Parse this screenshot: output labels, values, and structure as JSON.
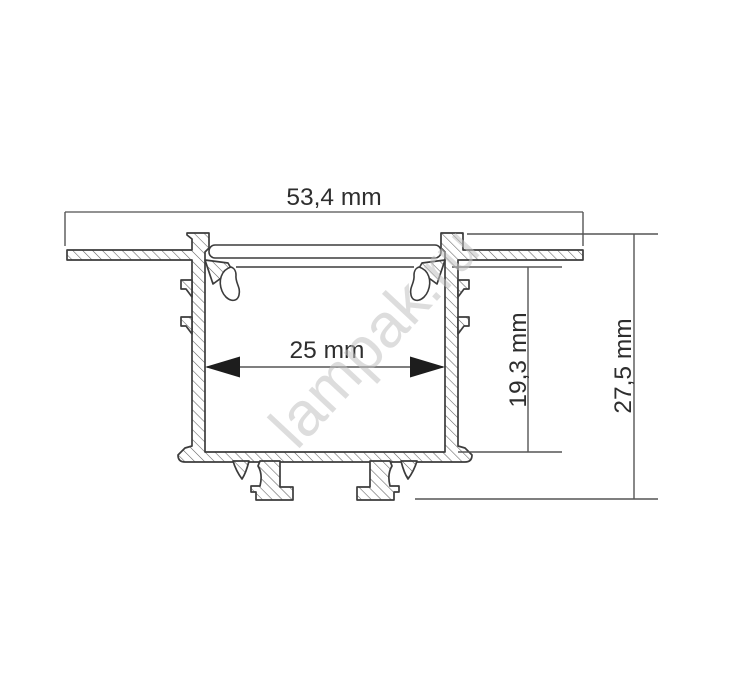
{
  "drawing": {
    "type": "technical-cross-section-profile",
    "watermark": "lampak.ru",
    "dimensions": {
      "total_width": "53,4 mm",
      "inner_width": "25 mm",
      "inner_depth": "19,3 mm",
      "total_height": "27,5 mm"
    },
    "colors": {
      "background": "#ffffff",
      "outline": "#3c3c3c",
      "hatch": "#5f5f5f",
      "dimension_line": "#6e6e6e",
      "text": "#2e2e2e",
      "arrow": "#1d1d1d",
      "watermark": "#c2c2c2"
    }
  }
}
